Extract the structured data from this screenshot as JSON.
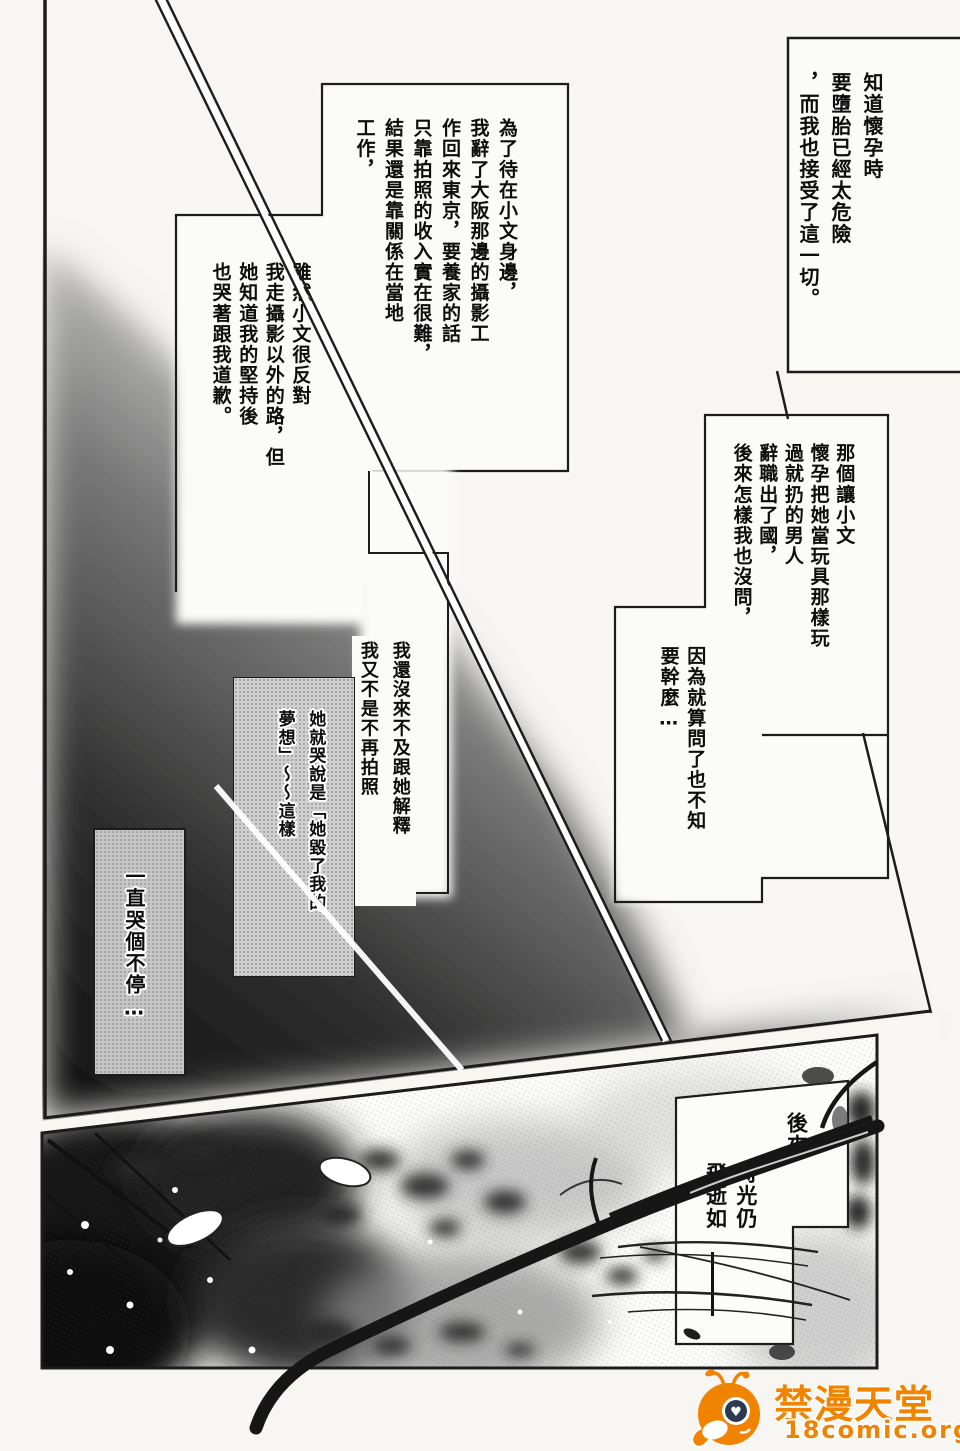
{
  "page": {
    "background": "#f7f6f3",
    "ink": "#1c1c1c"
  },
  "panel1": {
    "box1": {
      "columns": [
        "知道懷孕時",
        "要墮胎已經太危險",
        "，而我也接受了這一切。"
      ]
    },
    "box2": {
      "columns": [
        "為了待在小文身邊，",
        "我辭了大阪那邊的攝影工",
        "作回來東京，要養家的話",
        "只靠拍照的收入實在很難，",
        "結果還是靠關係在當地",
        "工作，"
      ]
    },
    "box3": {
      "columns": [
        "雖然小文很反對",
        "我走攝影以外的路，但",
        "她知道我的堅持後",
        "也哭著跟我道歉。"
      ]
    },
    "box4": {
      "columns": [
        "那個讓小文",
        "懷孕把她當玩具那樣玩",
        "過就扔的男人",
        "辭職出了國，",
        "後來怎樣我也沒問，"
      ]
    },
    "box5": {
      "columns": [
        "因為就算問了也不知",
        "要幹麼…"
      ]
    },
    "box6": {
      "columns": [
        "我還沒來不及跟她解釋",
        "我又不是不再拍照"
      ]
    },
    "box7": {
      "columns": [
        "她就哭說是「她毀了我的",
        "夢想」～～這樣"
      ]
    },
    "box8": {
      "columns": [
        "一直哭個不停…"
      ]
    }
  },
  "panel2": {
    "caption": {
      "columns": [
        "後來",
        "時光仍",
        "飛逝如"
      ]
    }
  },
  "watermark": {
    "site_name": "禁漫天堂",
    "site_url": "18comic.org",
    "color": "#f08300",
    "heart_glyph": "♥"
  }
}
